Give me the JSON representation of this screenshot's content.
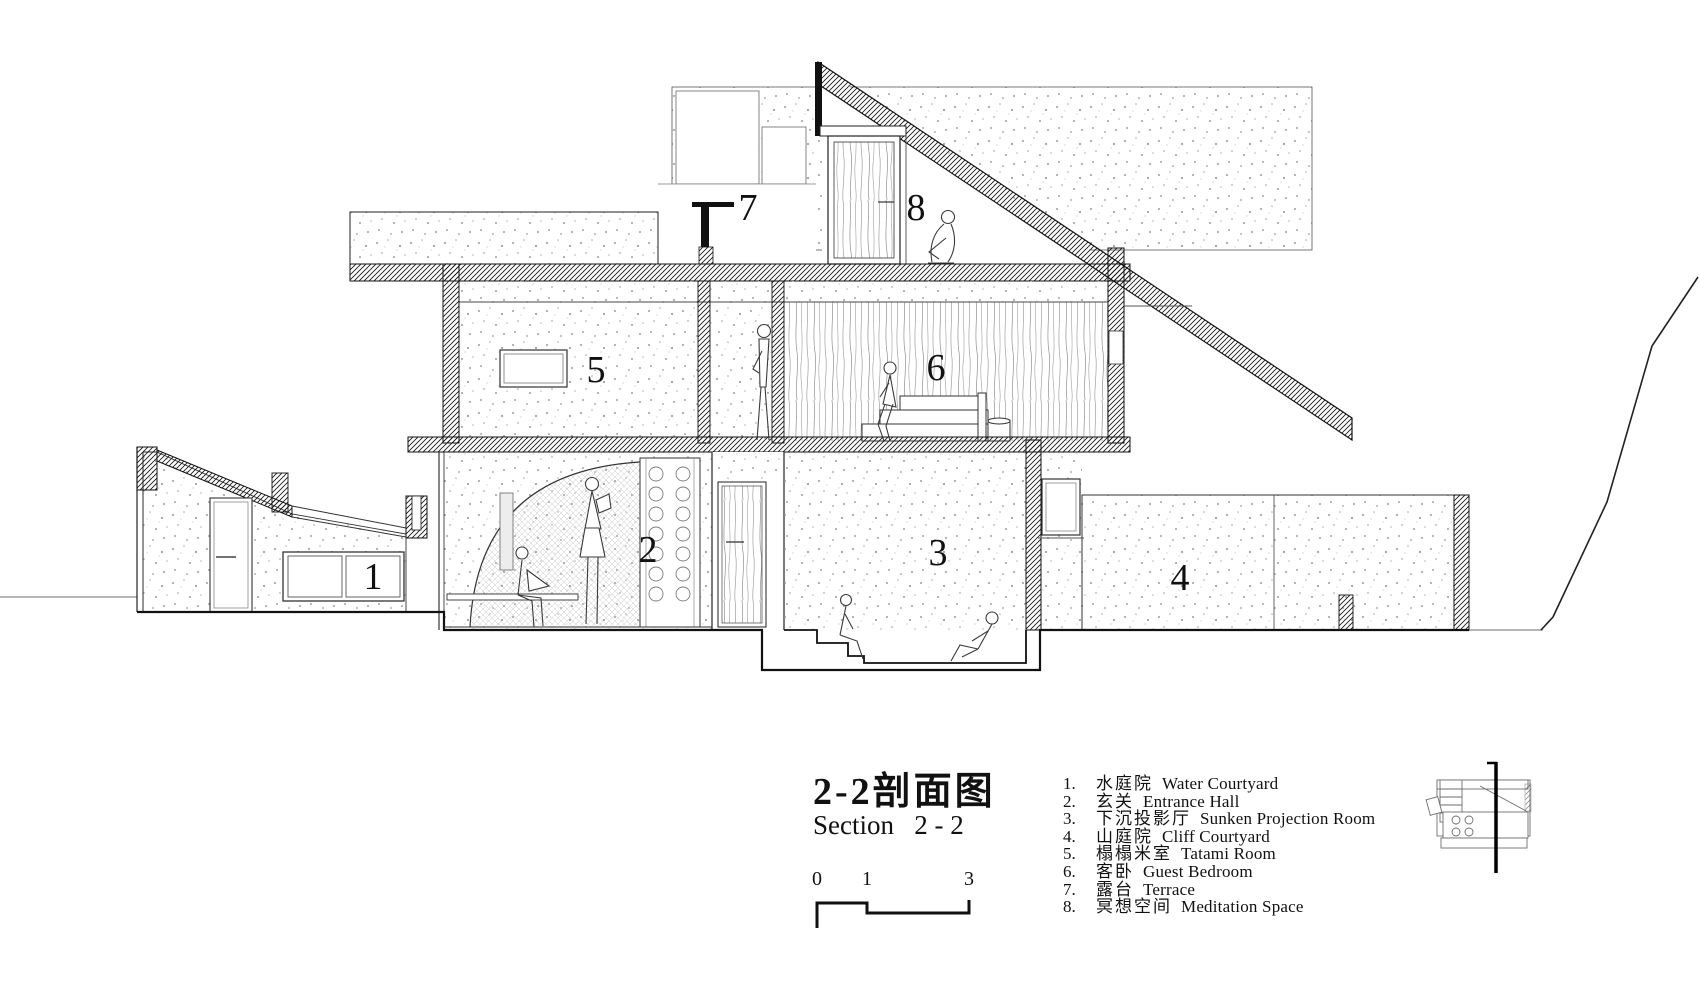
{
  "title": {
    "zh": "2-2剖面图",
    "en": "Section   2 - 2"
  },
  "scale_bar": {
    "labels": [
      "0",
      "1",
      "3"
    ]
  },
  "rooms": [
    {
      "number": "1",
      "legend_number": "1.",
      "zh": "水庭院",
      "en": "Water Courtyard"
    },
    {
      "number": "2",
      "legend_number": "2.",
      "zh": "玄关",
      "en": "Entrance Hall"
    },
    {
      "number": "3",
      "legend_number": "3.",
      "zh": "下沉投影厅",
      "en": "Sunken Projection Room"
    },
    {
      "number": "4",
      "legend_number": "4.",
      "zh": "山庭院",
      "en": "Cliff Courtyard"
    },
    {
      "number": "5",
      "legend_number": "5.",
      "zh": "榻榻米室",
      "en": "Tatami Room"
    },
    {
      "number": "6",
      "legend_number": "6.",
      "zh": "客卧",
      "en": "Guest Bedroom"
    },
    {
      "number": "7",
      "legend_number": "7.",
      "zh": "露台",
      "en": "Terrace"
    },
    {
      "number": "8",
      "legend_number": "8.",
      "zh": "冥想空间",
      "en": "Meditation Space"
    }
  ]
}
